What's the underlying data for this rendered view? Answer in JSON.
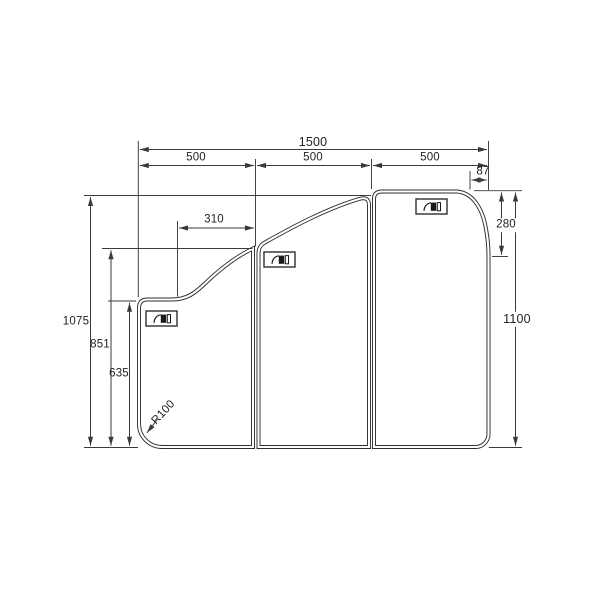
{
  "drawing": {
    "subject": "three-panel folding bathtub lid dimension drawing",
    "colors": {
      "background": "#ffffff",
      "line": "#3a3a3a",
      "outline": "#2f2f2f",
      "text": "#1f1f1f",
      "handle_fill": "#1a1a1a"
    },
    "dims": {
      "overall_width": "1500",
      "panel_width_left": "500",
      "panel_width_middle": "500",
      "panel_width_right": "500",
      "top_right_corner_width": "87",
      "left_step_offset": "310",
      "right_corner_height": "280",
      "right_side_height": "1100",
      "left_total_height": "1075",
      "fold_junction_height": "851",
      "left_edge_height": "635",
      "bottom_left_corner_radius": "R100"
    },
    "icons": [
      {
        "name": "handle-icon",
        "panel": "left"
      },
      {
        "name": "handle-icon",
        "panel": "middle"
      },
      {
        "name": "handle-icon",
        "panel": "right"
      }
    ]
  }
}
